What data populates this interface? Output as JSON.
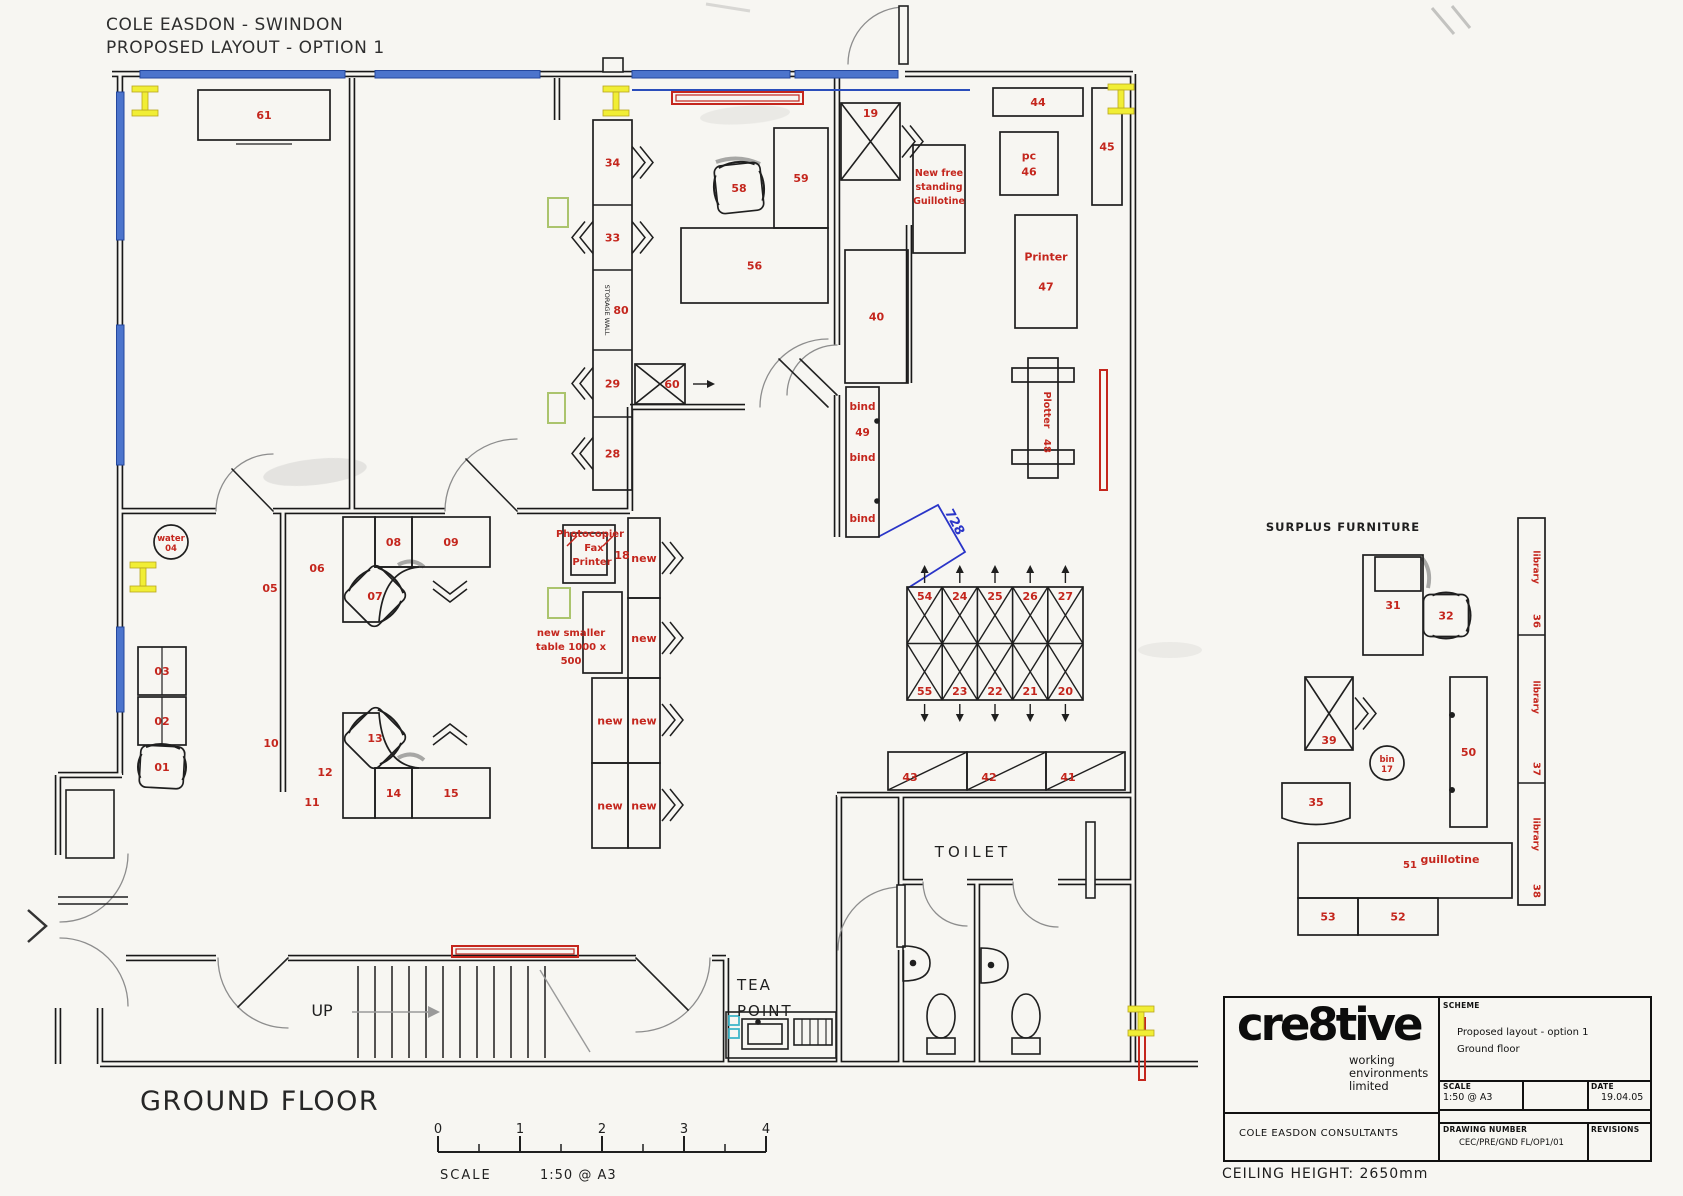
{
  "sheet": {
    "title_line1": "COLE EASDON - SWINDON",
    "title_line2": "PROPOSED LAYOUT - OPTION 1",
    "floor_label": "GROUND FLOOR",
    "ceiling_note": "CEILING HEIGHT: 2650mm"
  },
  "title_block": {
    "logo": "cre8tive",
    "logo_sub_lines": "working\nenvironments\nlimited",
    "client": "COLE EASDON CONSULTANTS",
    "scheme_label": "SCHEME",
    "scheme_lines": "Proposed layout - option 1\nGround floor",
    "scale_label": "SCALE",
    "scale_value": "1:50 @ A3",
    "date_label": "DATE",
    "date_value": "19.04.05",
    "drawing_number_label": "DRAWING NUMBER",
    "drawing_number_value": "CEC/PRE/GND FL/OP1/01",
    "revisions_label": "REVISIONS"
  },
  "colors": {
    "line": "#1f1f1f",
    "red": "#c4261d",
    "blue": "#4c74cc",
    "blue_dark": "#24479e",
    "dim": "#2a35c8",
    "yellow": "#f1ee35",
    "yellow_edge": "#b8a51f",
    "green": "#abc46d",
    "cyan": "#3fb6c9",
    "paper": "#f7f6f2",
    "gray": "#8a8a8a"
  },
  "plan": {
    "furniture": [
      {
        "k": "rect",
        "x": 198,
        "y": 90,
        "w": 132,
        "h": 50,
        "l": "61"
      },
      {
        "k": "stack",
        "x": 593,
        "y": 120,
        "w": 39,
        "units": [
          {
            "l": "34",
            "h": 85
          },
          {
            "l": "33",
            "h": 65
          },
          {
            "l": "80",
            "h": 80,
            "vt": "STORAGE WALL"
          },
          {
            "l": "29",
            "h": 67
          },
          {
            "l": "28",
            "h": 73
          }
        ]
      },
      {
        "k": "chair",
        "x": 716,
        "y": 164,
        "w": 46,
        "h": 48,
        "l": "58",
        "rot": -6
      },
      {
        "k": "rect",
        "x": 774,
        "y": 128,
        "w": 54,
        "h": 100,
        "l": "59"
      },
      {
        "k": "rect",
        "x": 681,
        "y": 228,
        "w": 147,
        "h": 75,
        "l": "56"
      },
      {
        "k": "xrect",
        "x": 635,
        "y": 364,
        "w": 50,
        "h": 40,
        "l": "60",
        "lx": 12,
        "arrow": "right"
      },
      {
        "k": "xrect",
        "x": 841,
        "y": 103,
        "w": 59,
        "h": 77,
        "l": "19",
        "lpos": "top",
        "chev": "right"
      },
      {
        "k": "rect",
        "x": 913,
        "y": 145,
        "w": 52,
        "h": 108,
        "l": ""
      },
      {
        "k": "rect",
        "x": 845,
        "y": 250,
        "w": 63,
        "h": 133,
        "l": "40"
      },
      {
        "k": "bind",
        "x": 846,
        "y": 387,
        "w": 33,
        "h": 150,
        "l1": "bind",
        "l2": "49",
        "l3": "bind",
        "l4": "bind"
      },
      {
        "k": "rect",
        "x": 993,
        "y": 88,
        "w": 90,
        "h": 28,
        "l": "44"
      },
      {
        "k": "rect",
        "x": 1092,
        "y": 88,
        "w": 30,
        "h": 117,
        "l": "45"
      },
      {
        "k": "rect",
        "x": 1000,
        "y": 132,
        "w": 58,
        "h": 63,
        "l": [
          "pc",
          "46"
        ]
      },
      {
        "k": "rect",
        "x": 1015,
        "y": 215,
        "w": 62,
        "h": 113,
        "l": [
          "Printer",
          "47"
        ],
        "lgap": 30
      },
      {
        "k": "plotter",
        "x": 1028,
        "y": 358,
        "w": 30,
        "h": 120,
        "l": "48",
        "vt": "Plotter"
      },
      {
        "k": "grid",
        "x": 907,
        "y": 587,
        "cw": 35.2,
        "ch": 56.5,
        "top": [
          "54",
          "24",
          "25",
          "26",
          "27"
        ],
        "bottom": [
          "55",
          "23",
          "22",
          "21",
          "20"
        ]
      },
      {
        "k": "shelfrow",
        "x": 888,
        "y": 752,
        "h": 38,
        "diag": true,
        "cells": [
          {
            "l": "43",
            "w": 79
          },
          {
            "l": "42",
            "w": 79
          },
          {
            "l": "41",
            "w": 79
          }
        ]
      },
      {
        "k": "circle",
        "cx": 171,
        "cy": 542,
        "r": 17,
        "l": [
          "water",
          "04"
        ]
      },
      {
        "k": "rect2",
        "x": 138,
        "y": 647,
        "w": 48,
        "h": 48,
        "l": "03"
      },
      {
        "k": "rect2",
        "x": 138,
        "y": 697,
        "w": 48,
        "h": 48,
        "l": "02"
      },
      {
        "k": "chair",
        "x": 140,
        "y": 746,
        "w": 44,
        "h": 42,
        "l": "01",
        "rot": 3
      },
      {
        "k": "rect",
        "x": 375,
        "y": 517,
        "w": 37,
        "h": 50,
        "l": "08"
      },
      {
        "k": "rect",
        "x": 412,
        "y": 517,
        "w": 78,
        "h": 50,
        "l": "09"
      },
      {
        "k": "chair",
        "x": 352,
        "y": 572,
        "w": 46,
        "h": 48,
        "l": "07",
        "rot": 45
      },
      {
        "k": "chev",
        "x": 450,
        "y": 581,
        "dir": "down"
      },
      {
        "k": "rect",
        "x": 375,
        "y": 768,
        "w": 37,
        "h": 50,
        "l": "14"
      },
      {
        "k": "rect",
        "x": 412,
        "y": 768,
        "w": 78,
        "h": 50,
        "l": "15"
      },
      {
        "k": "chair",
        "x": 352,
        "y": 714,
        "w": 46,
        "h": 48,
        "l": "13",
        "rot": 45
      },
      {
        "k": "chev",
        "x": 450,
        "y": 745,
        "dir": "up"
      },
      {
        "k": "rect",
        "x": 628,
        "y": 518,
        "w": 32,
        "h": 80,
        "l": "new"
      },
      {
        "k": "rect",
        "x": 628,
        "y": 598,
        "w": 32,
        "h": 80,
        "l": "new"
      },
      {
        "k": "rect",
        "x": 592,
        "y": 678,
        "w": 36,
        "h": 85,
        "l": "new"
      },
      {
        "k": "rect",
        "x": 628,
        "y": 678,
        "w": 32,
        "h": 85,
        "l": "new"
      },
      {
        "k": "rect",
        "x": 592,
        "y": 763,
        "w": 36,
        "h": 85,
        "l": "new"
      },
      {
        "k": "rect",
        "x": 628,
        "y": 763,
        "w": 32,
        "h": 85,
        "l": "new"
      },
      {
        "k": "chev",
        "x": 662,
        "y": 558,
        "dir": "right"
      },
      {
        "k": "chev",
        "x": 662,
        "y": 638,
        "dir": "right"
      },
      {
        "k": "chev",
        "x": 662,
        "y": 720,
        "dir": "right"
      },
      {
        "k": "chev",
        "x": 662,
        "y": 805,
        "dir": "right"
      },
      {
        "k": "copier",
        "x": 563,
        "y": 525,
        "w": 52,
        "h": 58
      },
      {
        "k": "rect",
        "x": 583,
        "y": 592,
        "w": 39,
        "h": 81,
        "l": ""
      },
      {
        "k": "bench",
        "x": 1282,
        "y": 783,
        "w": 68,
        "h": 42,
        "l": "35"
      },
      {
        "k": "xrect",
        "x": 1305,
        "y": 677,
        "w": 48,
        "h": 73,
        "l": "39",
        "lpos": "bottom",
        "chev": "right"
      },
      {
        "k": "rect",
        "x": 1363,
        "y": 555,
        "w": 60,
        "h": 100,
        "l": "31",
        "inner": true
      },
      {
        "k": "chair",
        "x": 1425,
        "y": 593,
        "w": 42,
        "h": 45,
        "l": "32",
        "rot": 90
      },
      {
        "k": "circle",
        "cx": 1387,
        "cy": 763,
        "r": 17,
        "l": [
          "bin",
          "17"
        ]
      },
      {
        "k": "rect",
        "x": 1450,
        "y": 677,
        "w": 37,
        "h": 150,
        "l": "50",
        "hinges": true
      },
      {
        "k": "vstack",
        "x": 1518,
        "y": 518,
        "w": 27,
        "units": [
          {
            "vt": "library",
            "l": "36",
            "h": 117
          },
          {
            "vt": "library",
            "l": "37",
            "h": 148
          },
          {
            "vt": "library",
            "l": "38",
            "h": 122
          }
        ]
      },
      {
        "k": "rect",
        "x": 1298,
        "y": 843,
        "w": 214,
        "h": 55,
        "l": ""
      },
      {
        "k": "shelfrow",
        "x": 1298,
        "y": 898,
        "h": 37,
        "diag": false,
        "cells": [
          {
            "l": "53",
            "w": 60
          },
          {
            "l": "52",
            "w": 80
          }
        ]
      },
      {
        "k": "redbar",
        "x": 672,
        "y": 92,
        "w": 131,
        "h": 12
      },
      {
        "k": "redbar",
        "x": 452,
        "y": 946,
        "w": 126,
        "h": 11
      },
      {
        "k": "redrect",
        "x": 1100,
        "y": 370,
        "w": 7,
        "h": 120
      },
      {
        "k": "redrect",
        "x": 1139,
        "y": 1018,
        "w": 6,
        "h": 62
      },
      {
        "k": "greenrect",
        "x": 548,
        "y": 198,
        "w": 20,
        "h": 29
      },
      {
        "k": "greenrect",
        "x": 548,
        "y": 393,
        "w": 17,
        "h": 30
      },
      {
        "k": "greenrect",
        "x": 548,
        "y": 588,
        "w": 22,
        "h": 30
      },
      {
        "k": "cyanrect",
        "x": 729,
        "y": 1016,
        "w": 10,
        "h": 9
      },
      {
        "k": "cyanrect",
        "x": 729,
        "y": 1029,
        "w": 10,
        "h": 9
      },
      {
        "k": "ibeam",
        "x": 132,
        "y": 86
      },
      {
        "k": "ibeam",
        "x": 603,
        "y": 86
      },
      {
        "k": "ibeam",
        "x": 1108,
        "y": 84
      },
      {
        "k": "ibeam",
        "x": 130,
        "y": 562
      },
      {
        "k": "ibeam",
        "x": 1128,
        "y": 1006
      }
    ],
    "labels": [
      {
        "t": "05",
        "x": 270,
        "y": 592
      },
      {
        "t": "06",
        "x": 317,
        "y": 572
      },
      {
        "t": "10",
        "x": 271,
        "y": 747
      },
      {
        "t": "11",
        "x": 312,
        "y": 806
      },
      {
        "t": "12",
        "x": 325,
        "y": 776
      },
      {
        "t": "18",
        "x": 622,
        "y": 559
      },
      {
        "t": "New free",
        "x": 939,
        "y": 176,
        "s": 9.5
      },
      {
        "t": "standing",
        "x": 939,
        "y": 190,
        "s": 9.5
      },
      {
        "t": "Guillotine",
        "x": 939,
        "y": 204,
        "s": 9.5
      },
      {
        "t": "Photocopier",
        "x": 590,
        "y": 537,
        "s": 10
      },
      {
        "t": "Fax",
        "x": 594,
        "y": 551,
        "s": 10
      },
      {
        "t": "Printer",
        "x": 592,
        "y": 565,
        "s": 10
      },
      {
        "t": "new smaller",
        "x": 571,
        "y": 636,
        "s": 10
      },
      {
        "t": "table 1000 x",
        "x": 571,
        "y": 650,
        "s": 10
      },
      {
        "t": "500",
        "x": 571,
        "y": 664,
        "s": 10
      },
      {
        "t": "728",
        "x": 951,
        "y": 524,
        "c": "dim",
        "s": 13,
        "rot": 62
      },
      {
        "t": "51",
        "x": 1410,
        "y": 868,
        "s": 10
      },
      {
        "t": "guillotine",
        "x": 1450,
        "y": 863,
        "s": 11
      },
      {
        "t": "SURPLUS FURNITURE",
        "x": 1343,
        "y": 531,
        "c": "k",
        "s": 11.5,
        "ls": 1
      },
      {
        "t": "TOILET",
        "x": 973,
        "y": 857,
        "c": "k",
        "s": 15,
        "b": 0,
        "ls": 4
      },
      {
        "t": "TEA",
        "x": 737,
        "y": 990,
        "c": "k",
        "s": 15,
        "b": 0,
        "ls": 2,
        "a": "start"
      },
      {
        "t": "POINT",
        "x": 737,
        "y": 1016,
        "c": "k",
        "s": 15,
        "b": 0,
        "ls": 2,
        "a": "start"
      },
      {
        "t": "UP",
        "x": 322,
        "y": 1016,
        "c": "k",
        "s": 16,
        "b": 0
      },
      {
        "t": "0",
        "x": 438,
        "y": 1133,
        "c": "k",
        "s": 13,
        "b": 0
      },
      {
        "t": "1",
        "x": 520,
        "y": 1133,
        "c": "k",
        "s": 13,
        "b": 0
      },
      {
        "t": "2",
        "x": 602,
        "y": 1133,
        "c": "k",
        "s": 13,
        "b": 0
      },
      {
        "t": "3",
        "x": 684,
        "y": 1133,
        "c": "k",
        "s": 13,
        "b": 0
      },
      {
        "t": "4",
        "x": 766,
        "y": 1133,
        "c": "k",
        "s": 13,
        "b": 0
      },
      {
        "t": "SCALE",
        "x": 440,
        "y": 1179,
        "c": "k",
        "s": 13,
        "b": 0,
        "ls": 2,
        "a": "start"
      },
      {
        "t": "1:50 @ A3",
        "x": 540,
        "y": 1179,
        "c": "k",
        "s": 13,
        "b": 0,
        "ls": 1,
        "a": "start"
      }
    ]
  }
}
